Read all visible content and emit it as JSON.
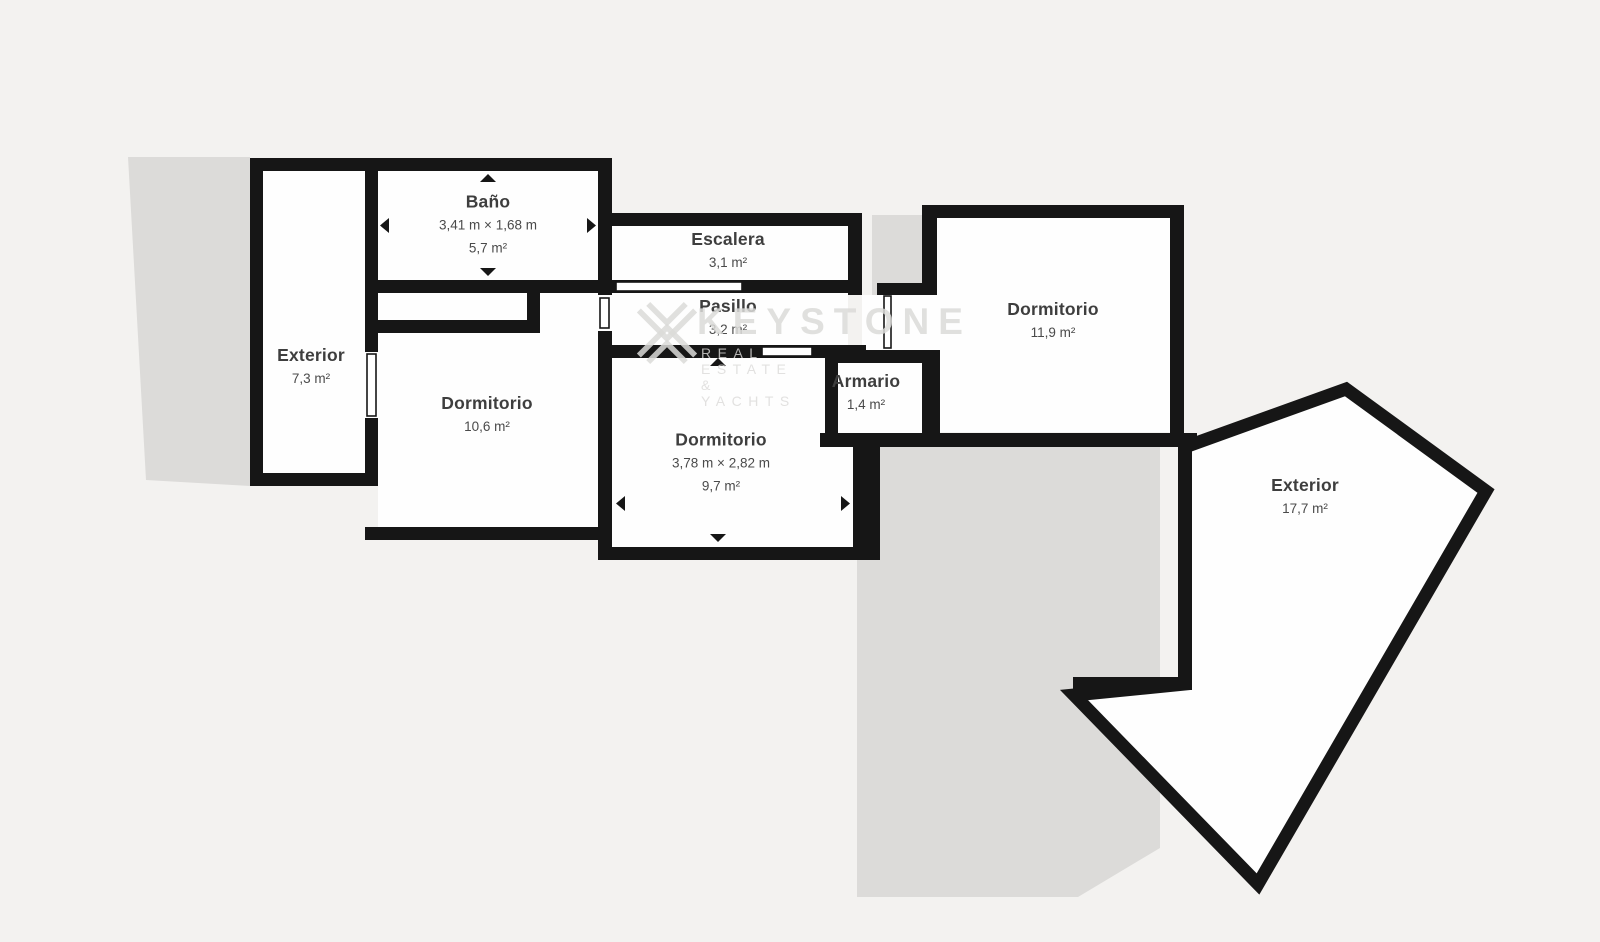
{
  "plan": {
    "rooms": {
      "bano": {
        "name": "Baño",
        "dims": "3,41 m × 1,68 m",
        "area": "5,7 m²"
      },
      "escalera": {
        "name": "Escalera",
        "area": "3,1 m²"
      },
      "pasillo": {
        "name": "Pasillo",
        "area": "3,2 m²"
      },
      "exterior_left": {
        "name": "Exterior",
        "area": "7,3 m²"
      },
      "dormitorio_1": {
        "name": "Dormitorio",
        "area": "10,6 m²"
      },
      "dormitorio_2": {
        "name": "Dormitorio",
        "dims": "3,78 m × 2,82 m",
        "area": "9,7 m²"
      },
      "armario": {
        "name": "Armario",
        "area": "1,4 m²"
      },
      "dormitorio_3": {
        "name": "Dormitorio",
        "area": "11,9 m²"
      },
      "exterior_right": {
        "name": "Exterior",
        "area": "17,7 m²"
      }
    },
    "watermark": {
      "brand": "KEYSTONE",
      "tagline": "REAL ESTATE & YACHTS"
    },
    "colors": {
      "background": "#f3f2f0",
      "shadow": "#dcdbd9",
      "wall": "#161616",
      "room_fill": "#fefefe",
      "label_text": "#3e3e3e",
      "watermark": "#dbdad8"
    }
  }
}
